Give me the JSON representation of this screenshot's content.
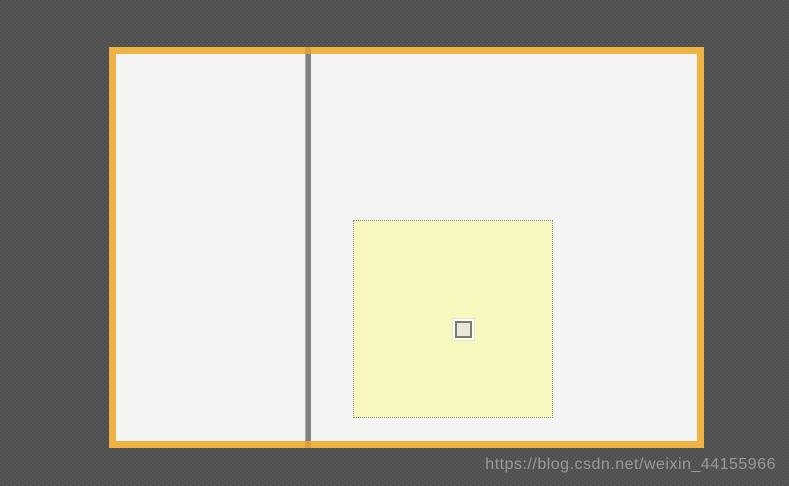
{
  "background": {
    "base_color": "#4e4e4e",
    "checker_color": "#575757"
  },
  "window": {
    "frame_border_color": "#efb344",
    "panel_color": "#f4f4f4",
    "splitter_color": "#828282",
    "splitter_cap_color": "#d9a23c"
  },
  "yellow_widget": {
    "fill_color": "#f7f8bd",
    "border_color": "#8a8a8a",
    "border_style": "dotted"
  },
  "small_box_widget": {
    "outer_color": "#fcfcf6",
    "frame_color": "#7c7c67",
    "fill_color": "#e8e7da"
  },
  "watermark": {
    "text": "https://blog.csdn.net/weixin_44155966",
    "color": "#9b9b9b"
  }
}
